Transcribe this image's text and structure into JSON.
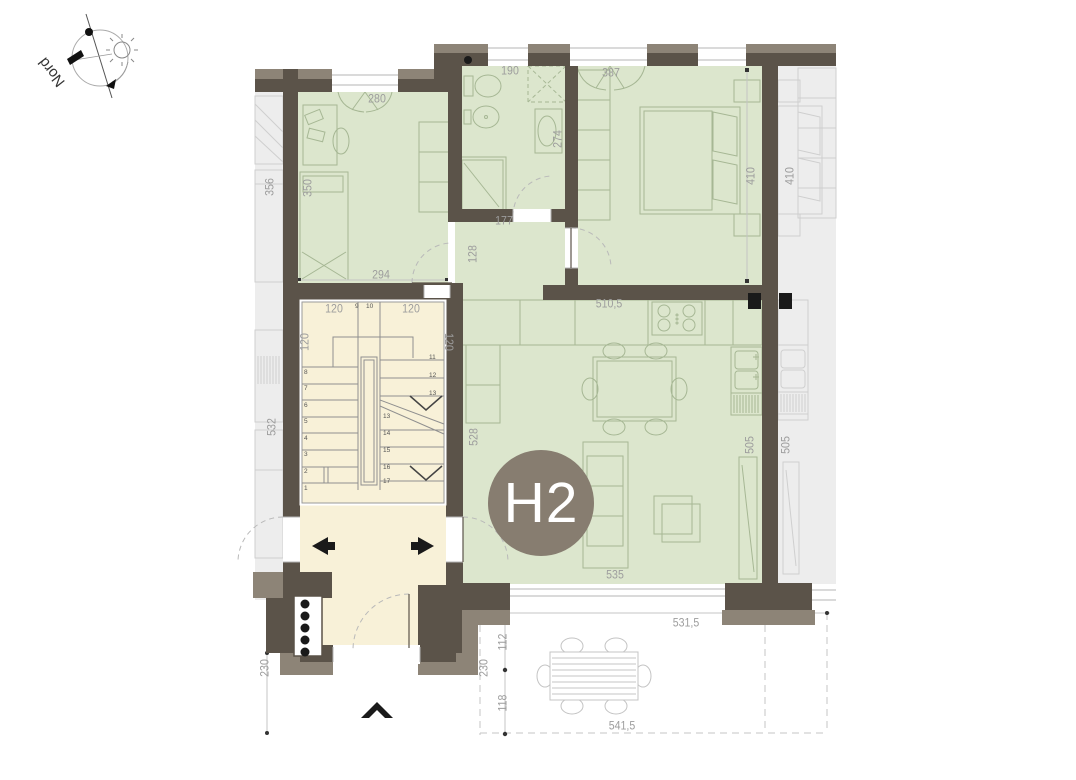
{
  "compass": {
    "label": "Nord"
  },
  "unit_badge": {
    "label": "H2"
  },
  "colors": {
    "apartment_fill": "#dce6cd",
    "stairwell_fill": "#f8f1d8",
    "neighbor_fill": "#ededed",
    "wall": "#5b5349",
    "wall_outer": "#8d8477",
    "badge": "#877d70",
    "dim_text": "#9d9d9d"
  },
  "dimensions": [
    {
      "t": "280",
      "x": 377,
      "y": 100,
      "r": 0
    },
    {
      "t": "190",
      "x": 510,
      "y": 72,
      "r": 0
    },
    {
      "t": "387",
      "x": 611,
      "y": 74,
      "r": 0
    },
    {
      "t": "356",
      "x": 271,
      "y": 187,
      "r": -90
    },
    {
      "t": "350",
      "x": 309,
      "y": 188,
      "r": -90
    },
    {
      "t": "274",
      "x": 559,
      "y": 139,
      "r": -90
    },
    {
      "t": "410",
      "x": 752,
      "y": 176,
      "r": -90
    },
    {
      "t": "410",
      "x": 791,
      "y": 176,
      "r": -90
    },
    {
      "t": "177",
      "x": 504,
      "y": 222,
      "r": 0
    },
    {
      "t": "128",
      "x": 474,
      "y": 254,
      "r": -90
    },
    {
      "t": "294",
      "x": 381,
      "y": 276,
      "r": 0
    },
    {
      "t": "510,5",
      "x": 609,
      "y": 305,
      "r": 0
    },
    {
      "t": "120",
      "x": 334,
      "y": 310,
      "r": 0
    },
    {
      "t": "120",
      "x": 411,
      "y": 310,
      "r": 0
    },
    {
      "t": "120",
      "x": 306,
      "y": 342,
      "r": -90
    },
    {
      "t": "120",
      "x": 447,
      "y": 342,
      "r": 90
    },
    {
      "t": "532",
      "x": 273,
      "y": 427,
      "r": -90
    },
    {
      "t": "528",
      "x": 475,
      "y": 437,
      "r": -90
    },
    {
      "t": "505",
      "x": 751,
      "y": 445,
      "r": -90
    },
    {
      "t": "505",
      "x": 787,
      "y": 445,
      "r": -90
    },
    {
      "t": "535",
      "x": 615,
      "y": 576,
      "r": 0
    },
    {
      "t": "531,5",
      "x": 686,
      "y": 624,
      "r": 0
    },
    {
      "t": "112",
      "x": 504,
      "y": 642,
      "r": -90
    },
    {
      "t": "230",
      "x": 266,
      "y": 668,
      "r": -90
    },
    {
      "t": "230",
      "x": 485,
      "y": 668,
      "r": -90
    },
    {
      "t": "118",
      "x": 504,
      "y": 703,
      "r": -90
    },
    {
      "t": "541,5",
      "x": 622,
      "y": 727,
      "r": 0
    }
  ],
  "stair_numbers": [
    {
      "t": "8",
      "x": 304,
      "y": 370
    },
    {
      "t": "7",
      "x": 304,
      "y": 386
    },
    {
      "t": "6",
      "x": 304,
      "y": 403
    },
    {
      "t": "5",
      "x": 304,
      "y": 419
    },
    {
      "t": "4",
      "x": 304,
      "y": 436
    },
    {
      "t": "3",
      "x": 304,
      "y": 452
    },
    {
      "t": "2",
      "x": 304,
      "y": 469
    },
    {
      "t": "1",
      "x": 304,
      "y": 486
    },
    {
      "t": "9",
      "x": 355,
      "y": 304
    },
    {
      "t": "10",
      "x": 366,
      "y": 304
    },
    {
      "t": "11",
      "x": 429,
      "y": 355
    },
    {
      "t": "12",
      "x": 429,
      "y": 373
    },
    {
      "t": "13",
      "x": 429,
      "y": 391
    },
    {
      "t": "13",
      "x": 383,
      "y": 414
    },
    {
      "t": "14",
      "x": 383,
      "y": 431
    },
    {
      "t": "15",
      "x": 383,
      "y": 448
    },
    {
      "t": "16",
      "x": 383,
      "y": 465
    },
    {
      "t": "17",
      "x": 383,
      "y": 479
    }
  ]
}
